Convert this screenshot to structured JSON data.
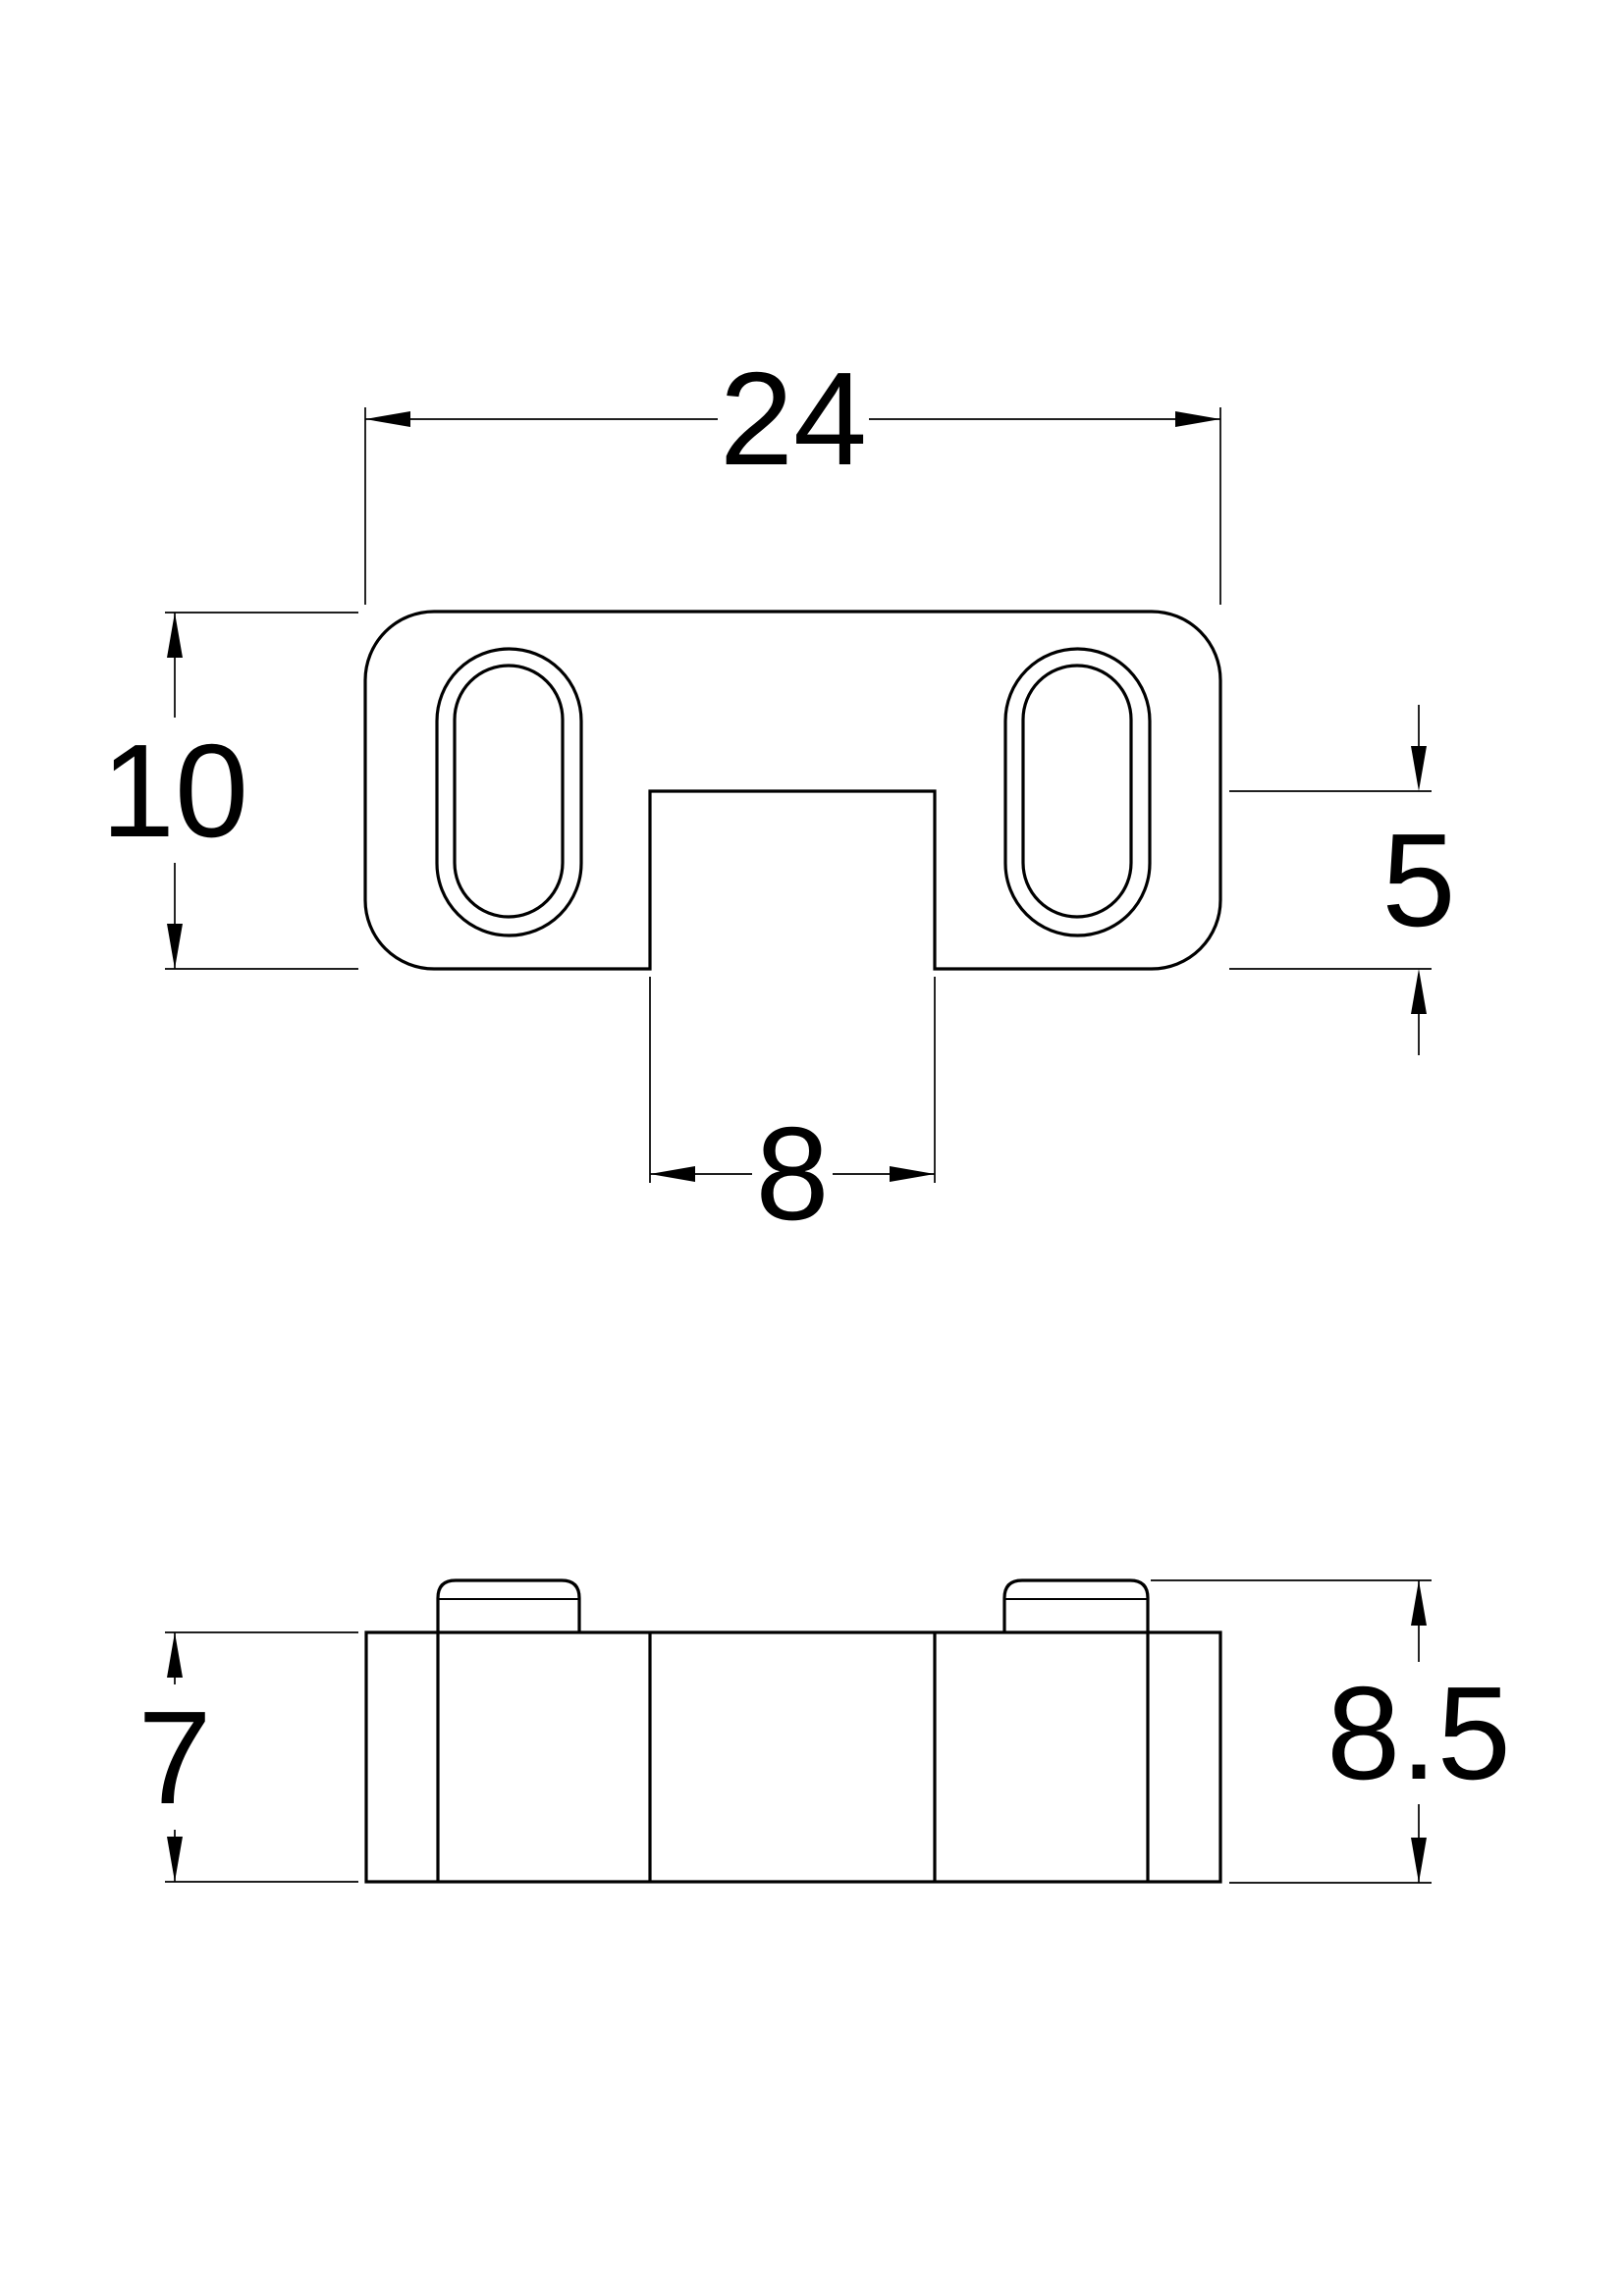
{
  "drawing": {
    "background": "#ffffff",
    "line_color": "#000000",
    "views": {
      "top_view": {
        "dim_overall_width": "24",
        "dim_overall_depth": "10",
        "dim_notch_depth": "5",
        "dim_notch_width": "8"
      },
      "front_view": {
        "dim_body_height": "7",
        "dim_overall_height": "8.5"
      }
    }
  }
}
